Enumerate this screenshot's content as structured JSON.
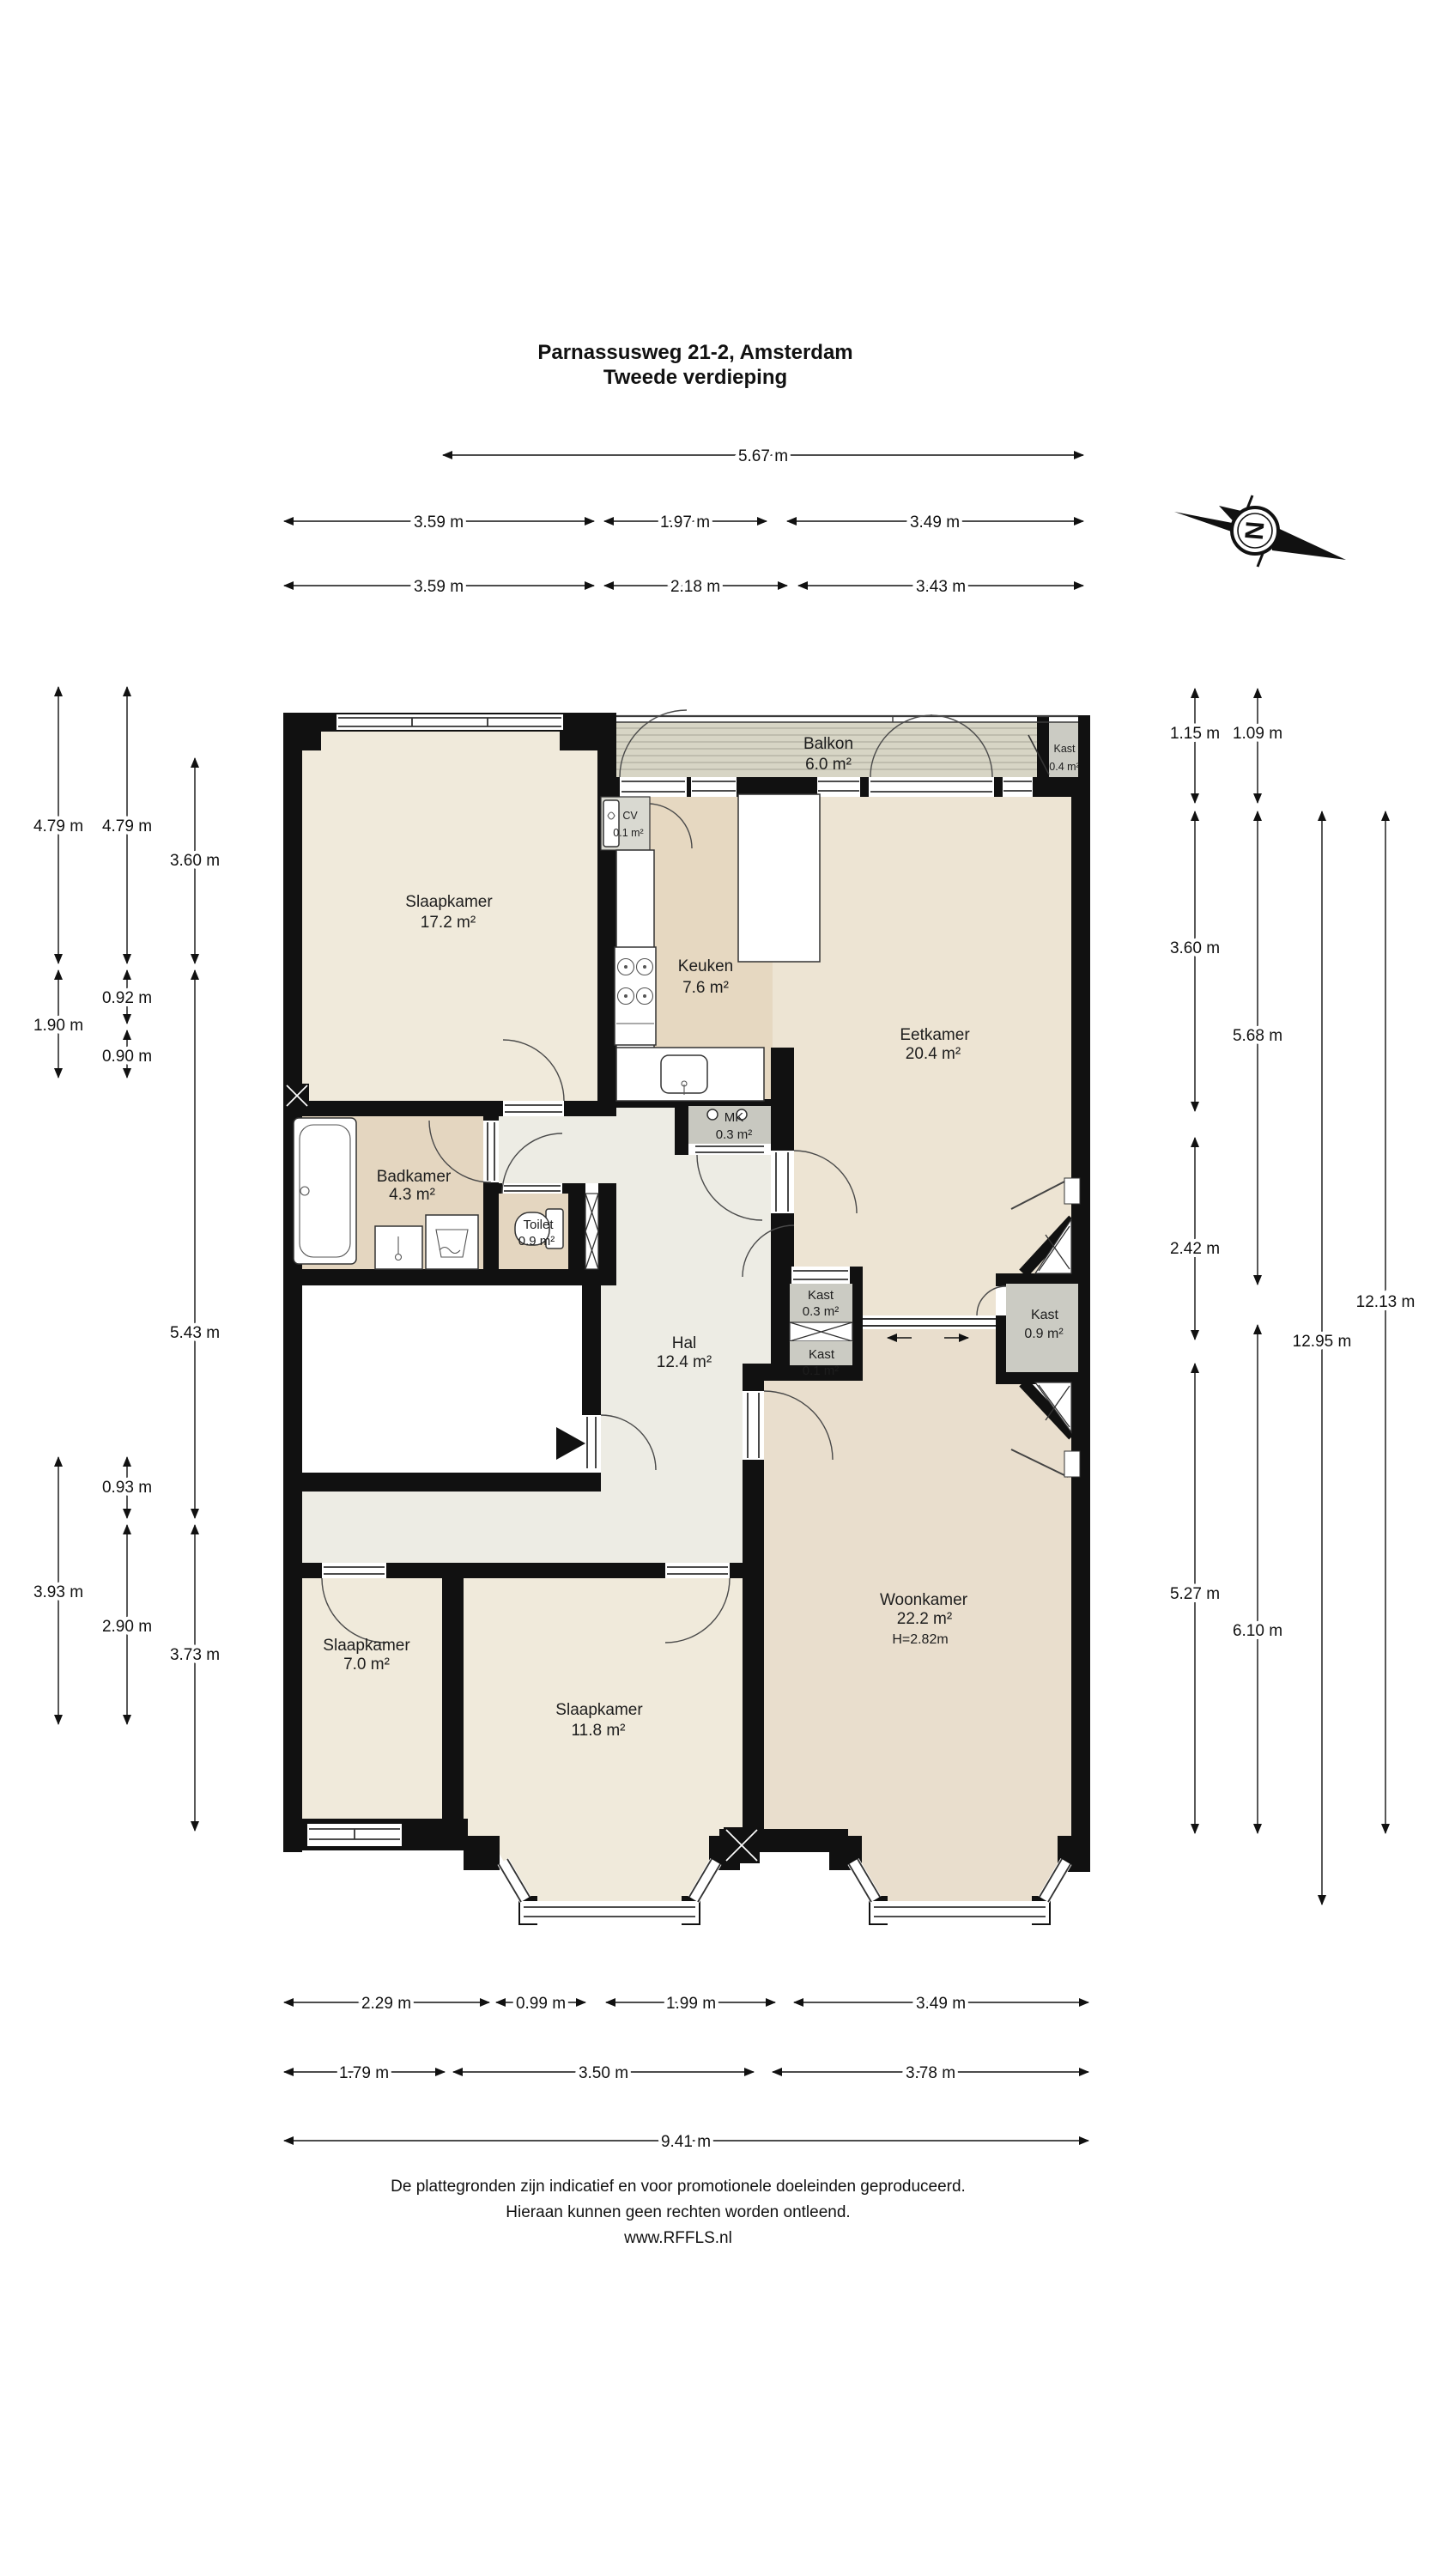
{
  "title": {
    "line1": "Parnassusweg 21-2, Amsterdam",
    "line2": "Tweede verdieping"
  },
  "compass": {
    "label": "N"
  },
  "rooms": {
    "balkon": {
      "name": "Balkon",
      "area": "6.0 m²"
    },
    "kast04": {
      "name": "Kast",
      "area": "0.4 m²"
    },
    "slaapkamer1": {
      "name": "Slaapkamer",
      "area": "17.2 m²"
    },
    "cv": {
      "name": "CV",
      "area": "0.1 m²"
    },
    "keuken": {
      "name": "Keuken",
      "area": "7.6 m²"
    },
    "eetkamer": {
      "name": "Eetkamer",
      "area": "20.4 m²"
    },
    "mk": {
      "name": "MK",
      "area": "0.3 m²"
    },
    "badkamer": {
      "name": "Badkamer",
      "area": "4.3 m²"
    },
    "toilet": {
      "name": "Toilet",
      "area": "0.9 m²"
    },
    "hal": {
      "name": "Hal",
      "area": "12.4 m²"
    },
    "kast03": {
      "name": "Kast",
      "area": "0.3 m²"
    },
    "kast01": {
      "name": "Kast",
      "area": "0.1 m²"
    },
    "kast09": {
      "name": "Kast",
      "area": "0.9 m²"
    },
    "woonkamer": {
      "name": "Woonkamer",
      "area": "22.2 m²",
      "height": "H=2.82m"
    },
    "slaapkamer2": {
      "name": "Slaapkamer",
      "area": "7.0 m²"
    },
    "slaapkamer3": {
      "name": "Slaapkamer",
      "area": "11.8 m²"
    }
  },
  "dimensions": {
    "top": [
      "5.67 m",
      "3.59 m",
      "1.97 m",
      "3.49 m",
      "3.59 m",
      "2.18 m",
      "3.43 m"
    ],
    "left": [
      "4.79 m",
      "4.79 m",
      "3.60 m",
      "1.90 m",
      "0.92 m",
      "0.90 m",
      "5.43 m",
      "0.93 m",
      "3.93 m",
      "2.90 m",
      "3.73 m"
    ],
    "right": [
      "1.15 m",
      "1.09 m",
      "3.60 m",
      "5.68 m",
      "2.42 m",
      "5.27 m",
      "6.10 m",
      "12.95 m",
      "12.13 m"
    ],
    "bottom": [
      "2.29 m",
      "0.99 m",
      "1.99 m",
      "3.49 m",
      "1.79 m",
      "3.50 m",
      "3.78 m",
      "9.41 m"
    ]
  },
  "footer": {
    "line1": "De plattegronden zijn indicatief en voor promotionele doeleinden geproduceerd.",
    "line2": "Hieraan kunnen geen rechten worden ontleend.",
    "line3": "www.RFFLS.nl"
  },
  "colors": {
    "wall": "#111111",
    "bedroom_floor": "#f0eadb",
    "dining_floor": "#ede4d3",
    "kitchen_floor": "#e6d8c1",
    "bath_floor": "#e4d6c0",
    "hall_floor": "#edece4",
    "living_floor": "#e9decd",
    "balcony_floor": "#d7d5c5",
    "closet_floor": "#cbcbc3"
  }
}
